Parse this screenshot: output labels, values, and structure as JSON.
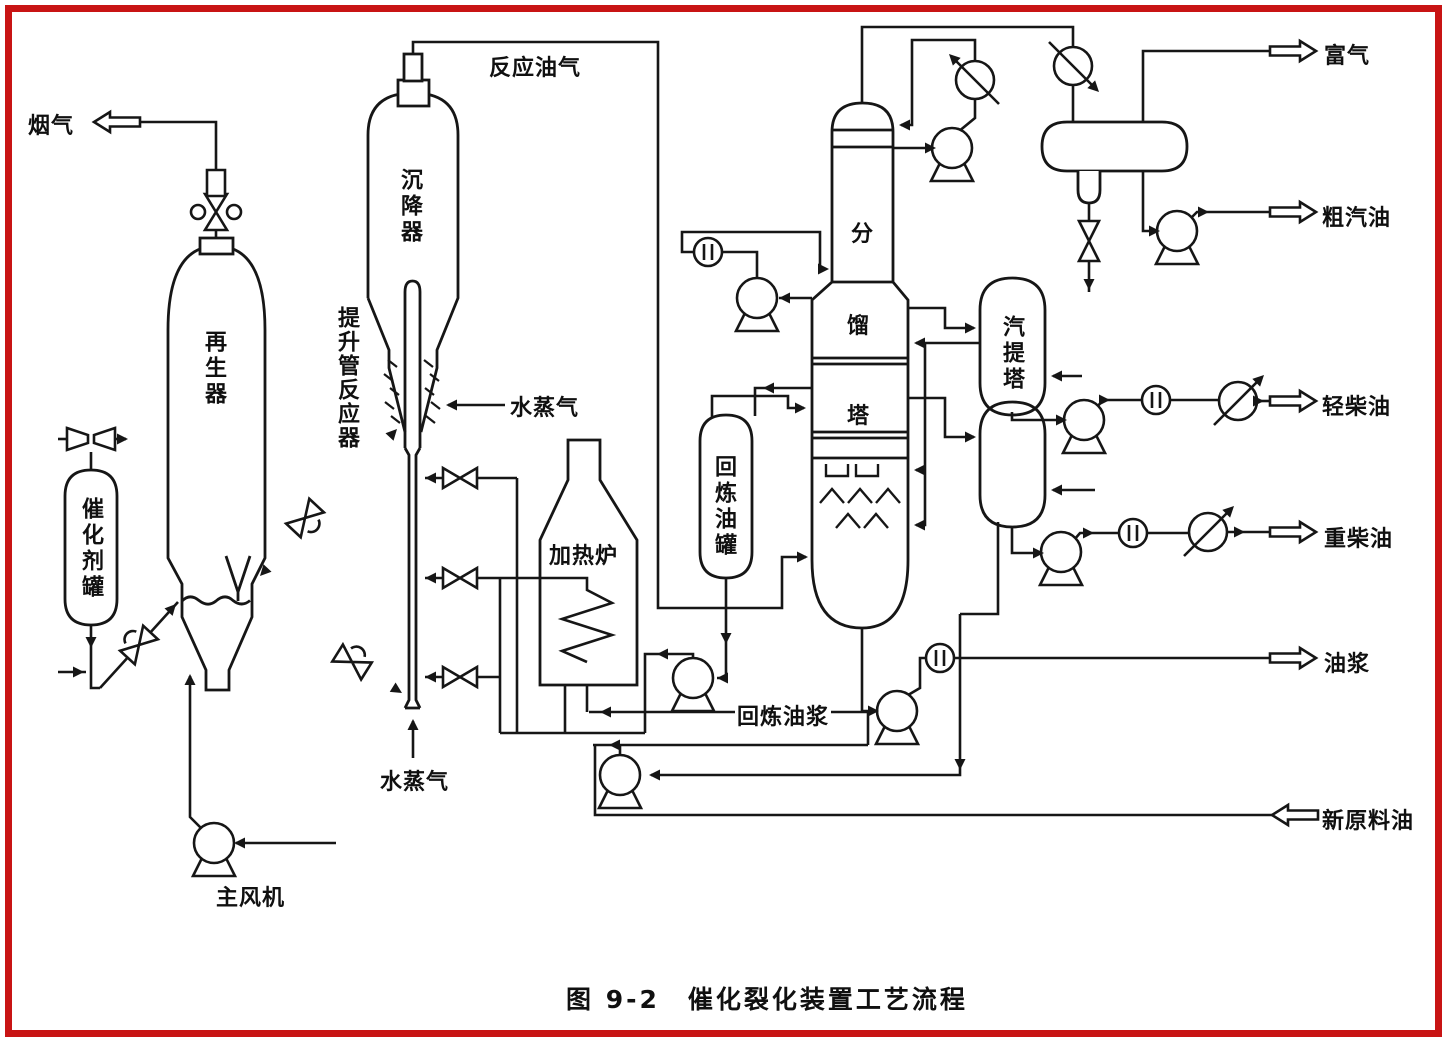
{
  "figure": {
    "caption": "图 9-2　催化裂化装置工艺流程"
  },
  "equipment_labels": {
    "regenerator": "再生器",
    "settler": "沉降器",
    "riser_reactor": "提升管反应器",
    "catalyst_tank": "催化剂罐",
    "heater": "加热炉",
    "recycle_oil_tank": "回炼油罐",
    "fractionator_char_1": "分",
    "fractionator_char_2": "馏",
    "fractionator_char_3": "塔",
    "stripper": "汽提塔",
    "main_blower": "主风机"
  },
  "stream_labels": {
    "flue_gas": "烟气",
    "reaction_oil_gas": "反应油气",
    "steam_riser_mid": "水蒸气",
    "steam_riser_bottom": "水蒸气",
    "recycle_slurry": "回炼油浆",
    "rich_gas": "富气",
    "crude_gasoline": "粗汽油",
    "light_diesel": "轻柴油",
    "heavy_diesel": "重柴油",
    "oil_slurry": "油浆",
    "fresh_feed": "新原料油"
  },
  "icon_names": [
    "pump-icon",
    "gate-valve-icon",
    "slide-valve-icon",
    "plug-valve-icon",
    "flow-meter-icon",
    "cooler-icon",
    "venturi-icon",
    "stream-arrow-icon"
  ],
  "colors": {
    "frame_red": "#c81414",
    "line_black": "#161616",
    "background": "#ffffff"
  }
}
